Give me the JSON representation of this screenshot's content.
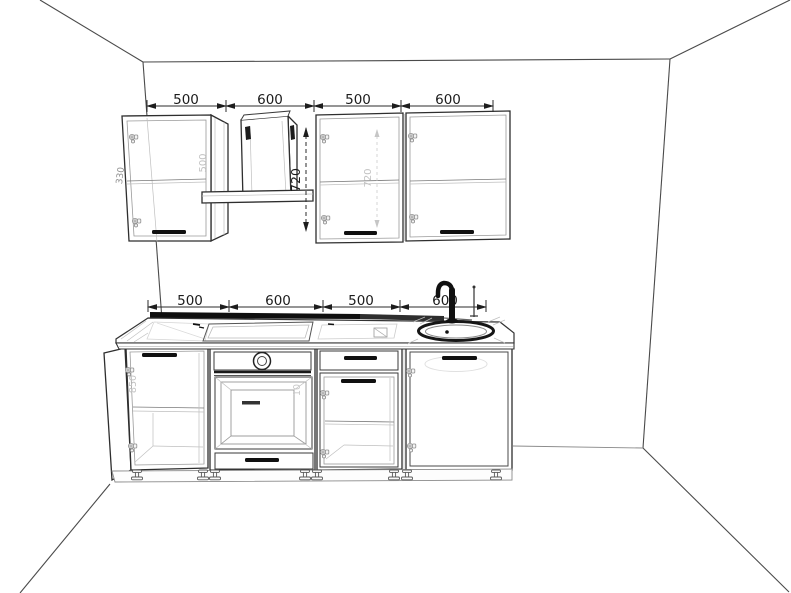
{
  "scene": {
    "kind": "kitchen-cabinet-set-perspective-line-drawing",
    "room": "empty room corner view, white walls, black line art"
  },
  "dimensions": {
    "wall_units": [
      "500",
      "600",
      "500",
      "600"
    ],
    "base_units": [
      "500",
      "600",
      "500",
      "600"
    ],
    "wall_unit_height": "720"
  },
  "faint_labels": {
    "wall_cabinet_1_width": "500",
    "wall_cabinet_1_side": "330",
    "wall_cabinet_3_height": "720",
    "base_cabinet_1_height": "850",
    "oven_niche": "10"
  },
  "colors": {
    "background": "#ffffff",
    "line": "#2e2e2e",
    "dark_accent": "#101010",
    "faint": "#c2c2c2"
  }
}
